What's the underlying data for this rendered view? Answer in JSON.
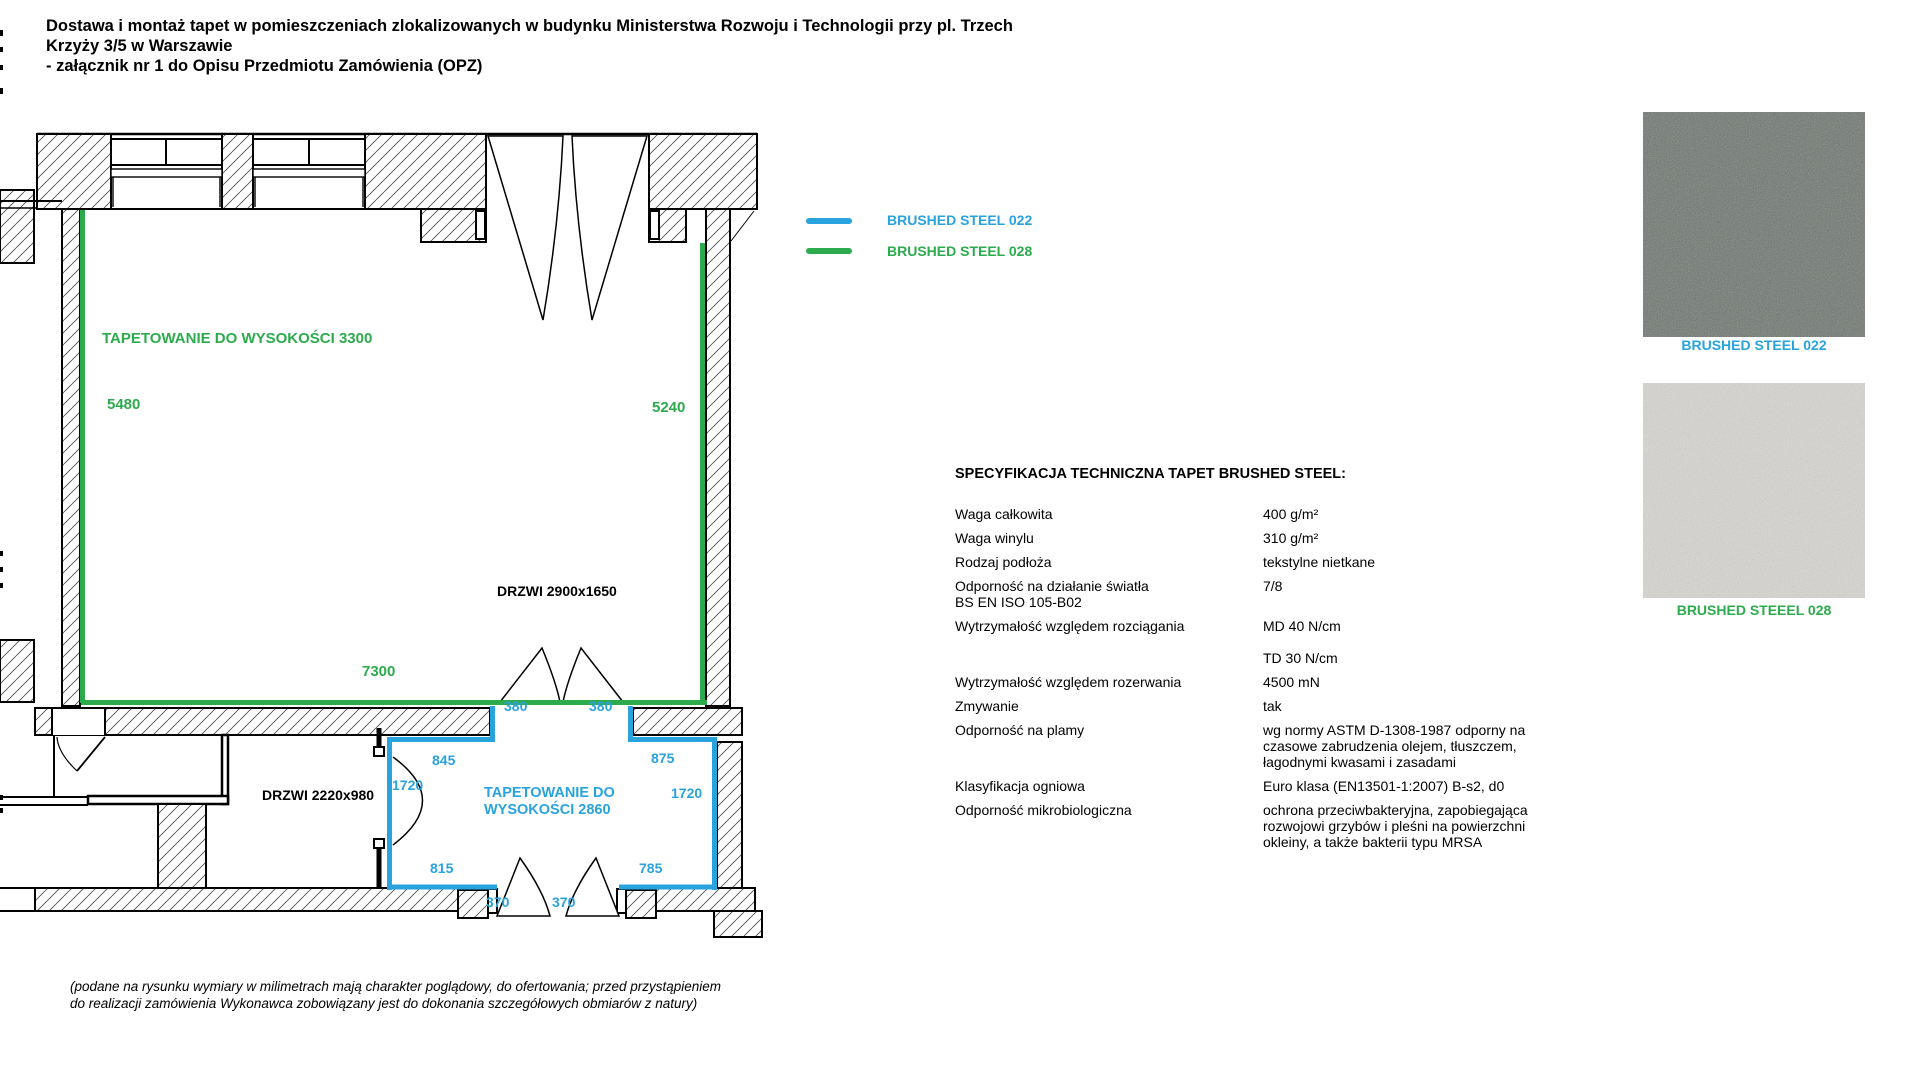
{
  "colors": {
    "blue": "#29A3DE",
    "green": "#2CAB4D",
    "swatch_022_base": "#6d746e",
    "swatch_028_base": "#d8d6d2"
  },
  "header": {
    "title_line1": "Dostawa i montaż tapet w pomieszczeniach zlokalizowanych w budynku Ministerstwa Rozwoju i Technologii przy pl. Trzech Krzyży 3/5 w Warszawie",
    "title_line2": "- załącznik nr 1 do Opisu Przedmiotu Zamówienia (OPZ)"
  },
  "legend": {
    "items": [
      {
        "label": "BRUSHED STEEL 022",
        "color": "#29A3DE"
      },
      {
        "label": "BRUSHED STEEL 028",
        "color": "#2CAB4D"
      }
    ]
  },
  "plan": {
    "upper_room": {
      "wallpaper_note": "TAPETOWANIE DO WYSOKOŚCI 3300",
      "dim_left": "5480",
      "dim_right": "5240",
      "dim_bottom": "7300",
      "door_label": "DRZWI 2900x1650"
    },
    "lower_room": {
      "wallpaper_note_line1": "TAPETOWANIE DO",
      "wallpaper_note_line2": "WYSOKOŚCI 2860",
      "door_label": "DRZWI 2220x980",
      "dim_gap_top_left": "380",
      "dim_gap_top_right": "380",
      "dim_top_left": "845",
      "dim_top_right": "875",
      "dim_side_left": "1720",
      "dim_side_right": "1720",
      "dim_bottom_left": "815",
      "dim_bottom_right": "785",
      "dim_gap_bottom_left": "370",
      "dim_gap_bottom_right": "370"
    }
  },
  "spec": {
    "heading": "SPECYFIKACJA TECHNICZNA TAPET BRUSHED STEEL:",
    "rows": [
      {
        "label": [
          "Waga całkowita"
        ],
        "value": [
          "400 g/m²"
        ]
      },
      {
        "label": [
          "Waga winylu"
        ],
        "value": [
          "310 g/m²"
        ]
      },
      {
        "label": [
          "Rodzaj podłoża"
        ],
        "value": [
          "tekstylne nietkane"
        ]
      },
      {
        "label": [
          "Odporność na działanie światła",
          "BS EN ISO 105-B02"
        ],
        "value": [
          "7/8"
        ]
      },
      {
        "label": [
          "Wytrzymałość względem rozciągania"
        ],
        "value": [
          "MD 40 N/cm",
          "",
          "TD 30 N/cm"
        ]
      },
      {
        "label": [
          "Wytrzymałość względem rozerwania"
        ],
        "value": [
          "4500 mN"
        ]
      },
      {
        "label": [
          "Zmywanie"
        ],
        "value": [
          "tak"
        ]
      },
      {
        "label": [
          "Odporność na plamy"
        ],
        "value": [
          "wg normy ASTM D-1308-1987 odporny na",
          "czasowe zabrudzenia olejem, tłuszczem,",
          "łagodnymi kwasami i zasadami"
        ]
      },
      {
        "label": [
          "Klasyfikacja ogniowa"
        ],
        "value": [
          "Euro klasa (EN13501-1:2007) B-s2, d0"
        ]
      },
      {
        "label": [
          "Odporność mikrobiologiczna"
        ],
        "value": [
          "ochrona przeciwbakteryjna, zapobiegająca",
          "rozwojowi grzybów i pleśni na powierzchni",
          "okleiny, a także bakterii typu MRSA"
        ]
      }
    ]
  },
  "swatches": [
    {
      "label": "BRUSHED STEEL 022",
      "base_color": "#6d746e",
      "label_color": "#29A3DE"
    },
    {
      "label": "BRUSHED STEEEL 028",
      "base_color": "#d8d6d2",
      "label_color": "#2CAB4D"
    }
  ],
  "footnote": {
    "line1": "(podane na rysunku wymiary w milimetrach mają charakter poglądowy, do ofertowania; przed przystąpieniem",
    "line2": "do realizacji zamówienia Wykonawca zobowiązany jest do dokonania szczegółowych obmiarów z natury)"
  }
}
